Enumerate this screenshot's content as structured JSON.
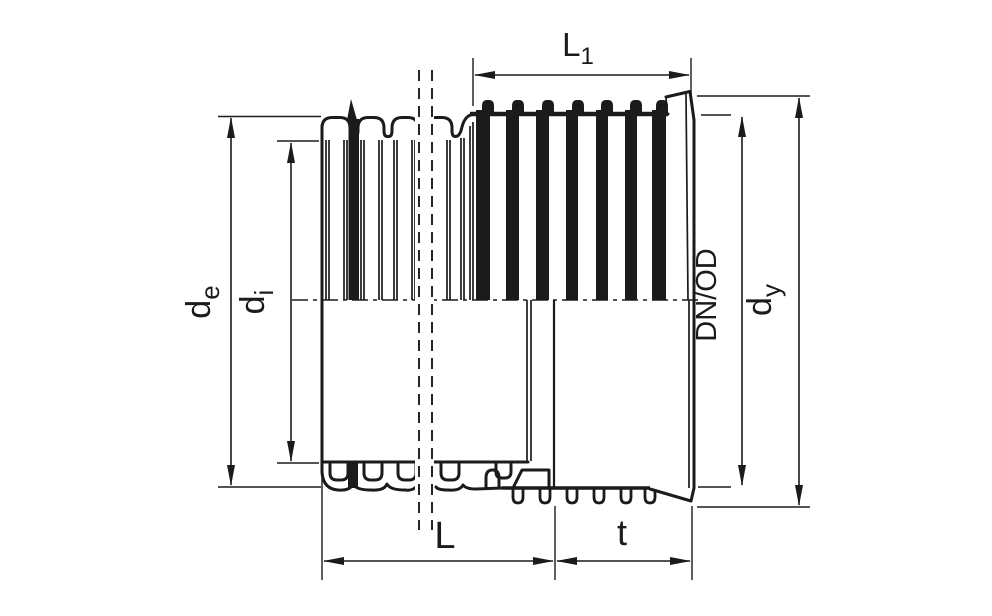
{
  "diagram": {
    "colors": {
      "ink": "#1b1b1b",
      "background": "#ffffff"
    },
    "labels": {
      "l1": {
        "main": "L",
        "sub": "1"
      },
      "de": {
        "main": "d",
        "sub": "e"
      },
      "di": {
        "main": "d",
        "sub": "i"
      },
      "dn_od": "DN/OD",
      "dy": {
        "main": "d",
        "sub": "y"
      },
      "l": "L",
      "t": "t"
    }
  }
}
